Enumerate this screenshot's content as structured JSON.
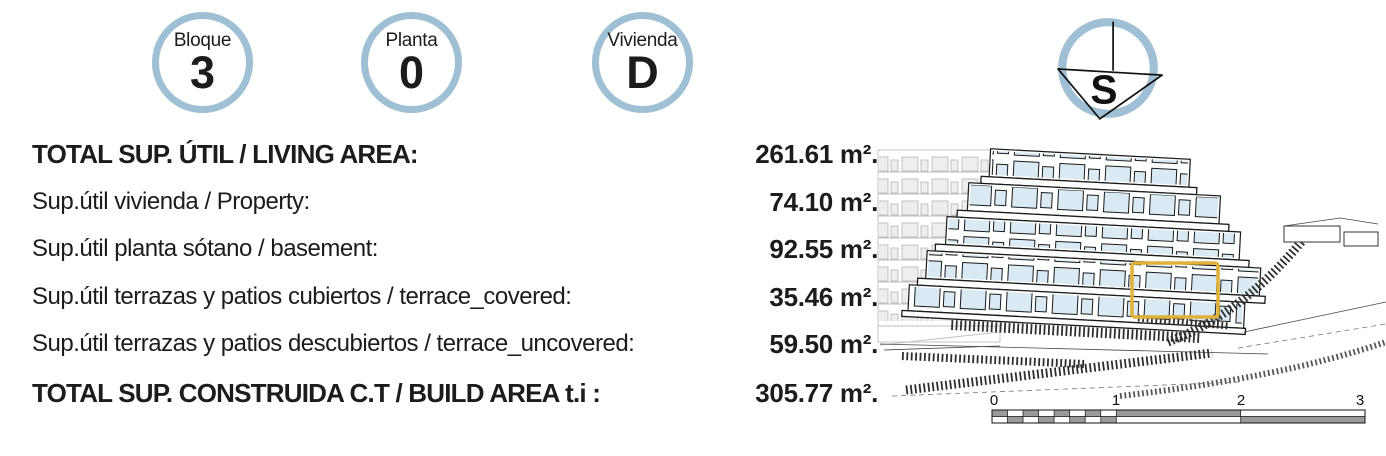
{
  "badges": [
    {
      "label": "Bloque",
      "value": "3"
    },
    {
      "label": "Planta",
      "value": "0"
    },
    {
      "label": "Vivienda",
      "value": "D"
    }
  ],
  "compass": {
    "letter": "S"
  },
  "area_table": {
    "rows": [
      {
        "label": "TOTAL SUP. ÚTIL / LIVING AREA:",
        "value": "261.61 m².",
        "emphasis": "bold"
      },
      {
        "label": "Sup.útil vivienda / Property:",
        "value": "74.10 m².",
        "emphasis": "normal"
      },
      {
        "label": "Sup.útil planta sótano / basement:",
        "value": "92.55 m².",
        "emphasis": "normal"
      },
      {
        "label": "Sup.útil terrazas y patios cubiertos / terrace_covered:",
        "value": "35.46 m².",
        "emphasis": "normal"
      },
      {
        "label": "Sup.útil terrazas y patios descubiertos / terrace_uncovered:",
        "value": "59.50 m².",
        "emphasis": "normal"
      },
      {
        "label": "TOTAL SUP. CONSTRUIDA C.T / BUILD AREA t.i :",
        "value": "305.77 m².",
        "emphasis": "bold"
      }
    ]
  },
  "scale_bar": {
    "tick_labels": [
      "0",
      "1",
      "2",
      "3"
    ]
  },
  "colors": {
    "badge_ring": "#9fbfd4",
    "highlight_box": "#e0b23a",
    "text": "#1c1c1c",
    "window_tint": "#d9eaf4",
    "scale_gray": "#9a9a9a"
  }
}
